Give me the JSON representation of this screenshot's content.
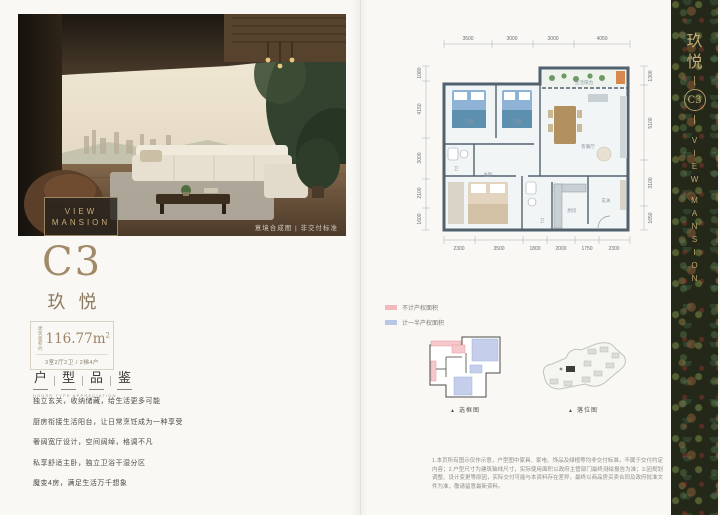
{
  "left_page": {
    "photo": {
      "badge_line1": "VIEW",
      "badge_line2": "MANSION",
      "caption": "意境合成图 | 非交付标准"
    },
    "unit": {
      "code": "C3",
      "name": "玖悦",
      "area_label": "建筑面积约",
      "area_value": "116.77m",
      "area_sup": "2",
      "layout_spec": "3室2厅2卫 / 2梯4户"
    },
    "section": {
      "title_chars": [
        "户",
        "型",
        "品",
        "鉴"
      ],
      "subtitle": "HOUSE TYPE APPRECIATION"
    },
    "features": [
      "独立玄关，收纳储藏，给生活更多可能",
      "厨房衔接生活阳台，让日常烹饪成为一种享受",
      "奢阔宽厅设计，空间阔绰，格调不凡",
      "私享舒适主卧，独立卫浴干湿分区",
      "魔变4房，满足生活万千想象"
    ]
  },
  "right_page": {
    "floorplan": {
      "dims_top": [
        "3500",
        "3000",
        "3000",
        "4050"
      ],
      "dims_bottom": [
        "2300",
        "3500",
        "1800",
        "2000",
        "1750",
        "2300"
      ],
      "dims_left": [
        "1080",
        "4150",
        "3000",
        "2100",
        "1600"
      ],
      "dims_right": [
        "1300",
        "5100",
        "3100",
        "1650"
      ],
      "rooms": {
        "bedroom1": "次卧",
        "bedroom2": "次卧",
        "master": "主卧",
        "living": "客餐厅",
        "balcony": "生活阳台",
        "kitchen": "厨房",
        "bath1": "卫",
        "bath2": "卫",
        "entry": "玄关"
      }
    },
    "legend": [
      {
        "color": "#f2b8bb",
        "label": "不计产权面积"
      },
      {
        "color": "#b9c7e6",
        "label": "计一半产权面积"
      }
    ],
    "mini_diagrams": {
      "marker": "▲",
      "keyplan_caption": "选框图",
      "siteplan_caption": "落位图"
    },
    "disclaimer": "1.本页所有图示仅作示意，户型图中家具、家电、饰品及绿植等均非交付标准，不属于交付约定内容；2.户型尺寸为建筑轴线尺寸，实际使用面积以政府主管部门最终测绘报告为准；3.因规划调整、设计变更等原因，实际交付可能与本资料存在差异，最终以商品房买卖合同及政府批准文件为准，敬请留意最新资料。"
  },
  "sidebar": {
    "title": "玖悦",
    "unit_code": "C3",
    "english": "VIEW MANSION"
  },
  "colors": {
    "accent_gold": "#a18a68",
    "sidebar_gold": "#c6aa79",
    "wall": "#51616d",
    "legend_pink": "#f2b8bb",
    "legend_blue": "#b9c7e6"
  }
}
